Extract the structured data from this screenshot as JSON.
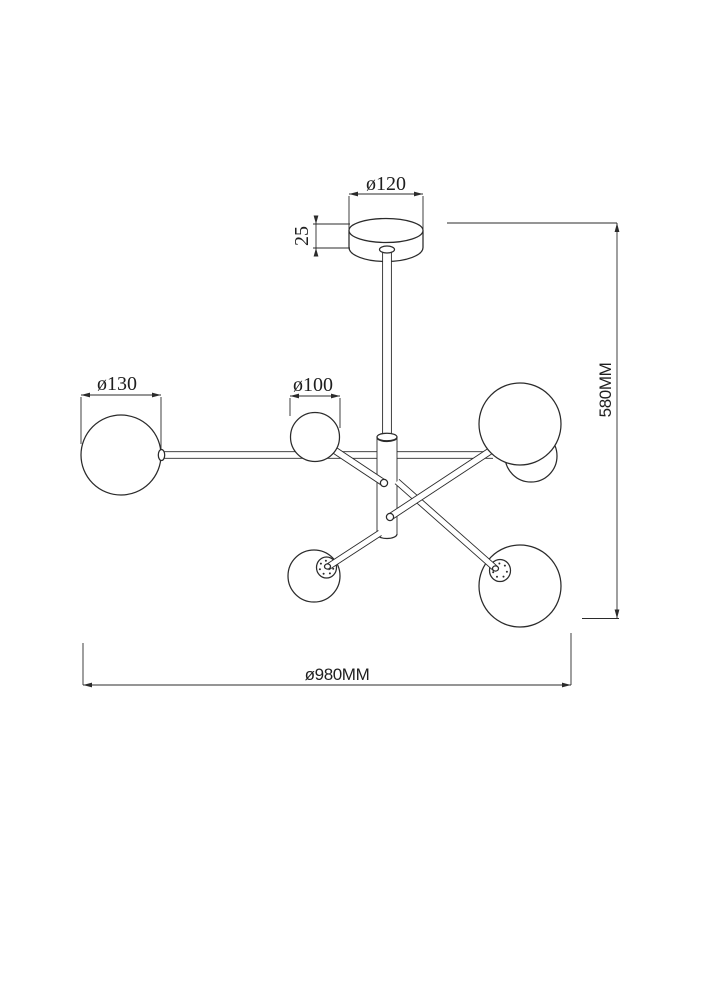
{
  "drawing": {
    "description": "Technical dimension drawing of a 6-globe sputnik ceiling chandelier: ceiling canopy with central stem, vertical hub, straight and angled arms ending in spherical glass shades",
    "colors": {
      "line": "#2b2b2b",
      "background": "#ffffff"
    },
    "labels": {
      "canopy_diameter": "ø120",
      "canopy_height": "25",
      "large_globe_diameter": "ø130",
      "small_globe_diameter": "ø100",
      "overall_height": "580MM",
      "overall_width": "ø980MM"
    },
    "values_mm": {
      "canopy_diameter": 120,
      "canopy_height": 25,
      "large_globe_diameter": 130,
      "small_globe_diameter": 100,
      "overall_height": 580,
      "overall_width": 980
    }
  }
}
